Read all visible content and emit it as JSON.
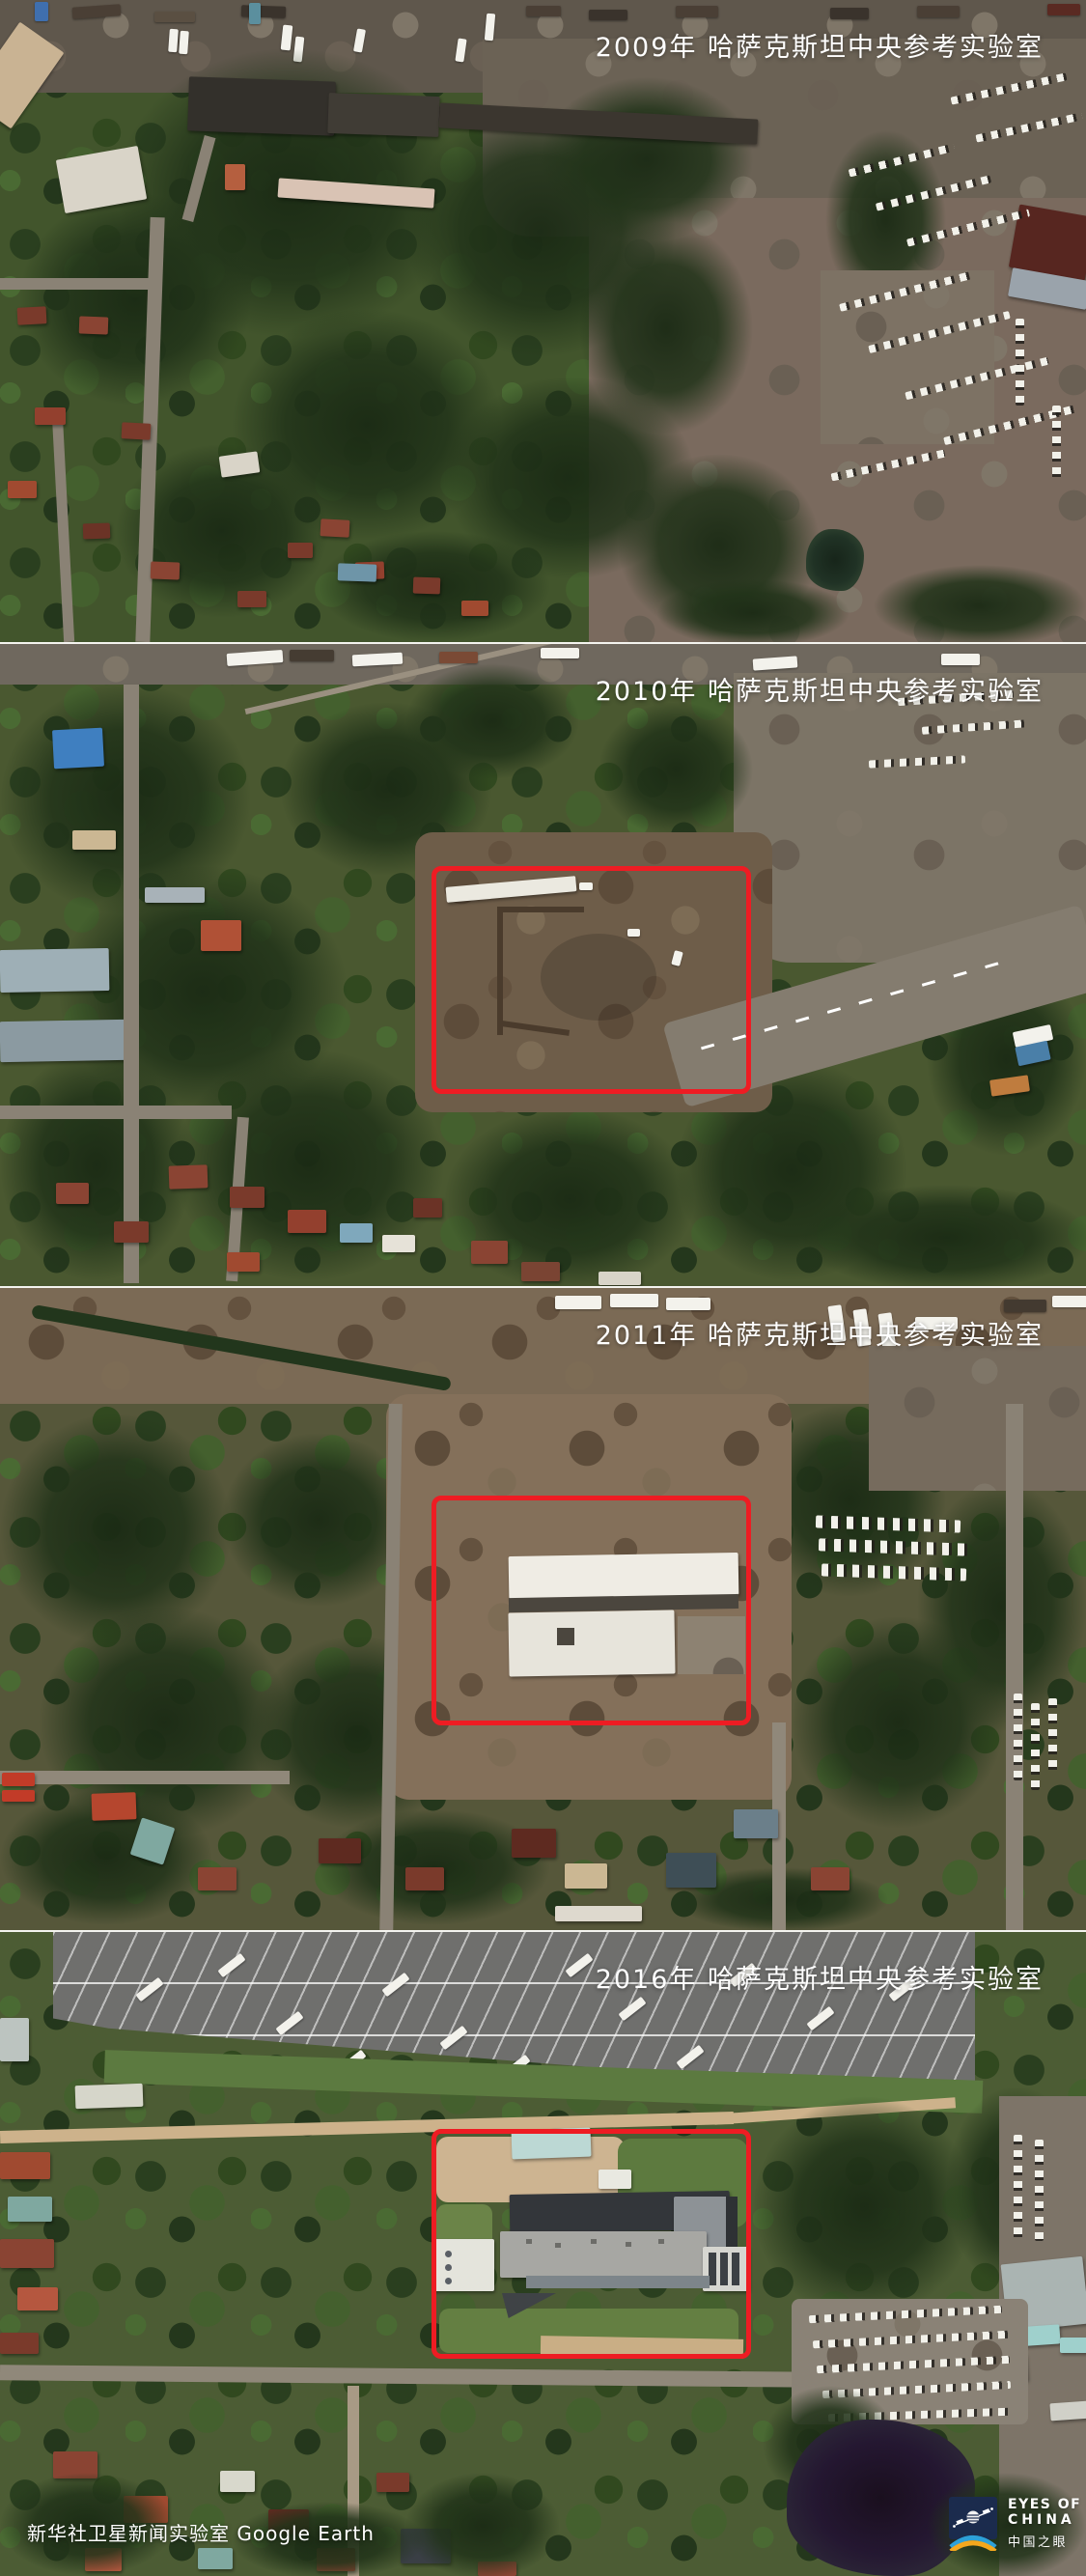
{
  "panels": [
    {
      "year_label": "2009年 哈萨克斯坦中央参考实验室"
    },
    {
      "year_label": "2010年 哈萨克斯坦中央参考实验室"
    },
    {
      "year_label": "2011年 哈萨克斯坦中央参考实验室"
    },
    {
      "year_label": "2016年 哈萨克斯坦中央参考实验室"
    }
  ],
  "credit": "新华社卫星新闻实验室  Google Earth",
  "logo": {
    "line1": "EYES OF",
    "line2": "CHINA",
    "line3": "中国之眼"
  },
  "colors": {
    "annotation_red": "#ee1c23",
    "label_white": "#ffffff",
    "logo_navy": "#1b2b4d",
    "logo_arc_blue": "#2da0d8",
    "logo_arc_yellow": "#f4a71d"
  }
}
